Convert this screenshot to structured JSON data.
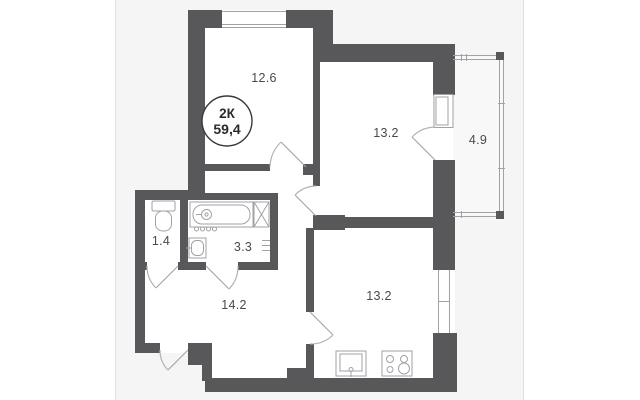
{
  "floor_plan": {
    "badge": {
      "room_count": "2К",
      "total_area": "59,4"
    },
    "rooms": [
      {
        "name": "bedroom",
        "area": "12.6"
      },
      {
        "name": "living-room",
        "area": "13.2"
      },
      {
        "name": "balcony",
        "area": "4.9"
      },
      {
        "name": "wc",
        "area": "1.4"
      },
      {
        "name": "bathroom",
        "area": "3.3"
      },
      {
        "name": "hallway",
        "area": "14.2"
      },
      {
        "name": "kitchen",
        "area": "13.2"
      }
    ],
    "colors": {
      "wall": "#58585a",
      "panel_background": "#f5f5f6",
      "room_fill": "#ffffff",
      "balcony_fill": "#f8f8f9",
      "fixture_stroke": "#a2a2a6",
      "door_stroke": "#b2b2b5",
      "label_color": "#4a4a4c",
      "badge_text": "#2b2b2d",
      "panel_edge": "#e0e0e2"
    }
  }
}
